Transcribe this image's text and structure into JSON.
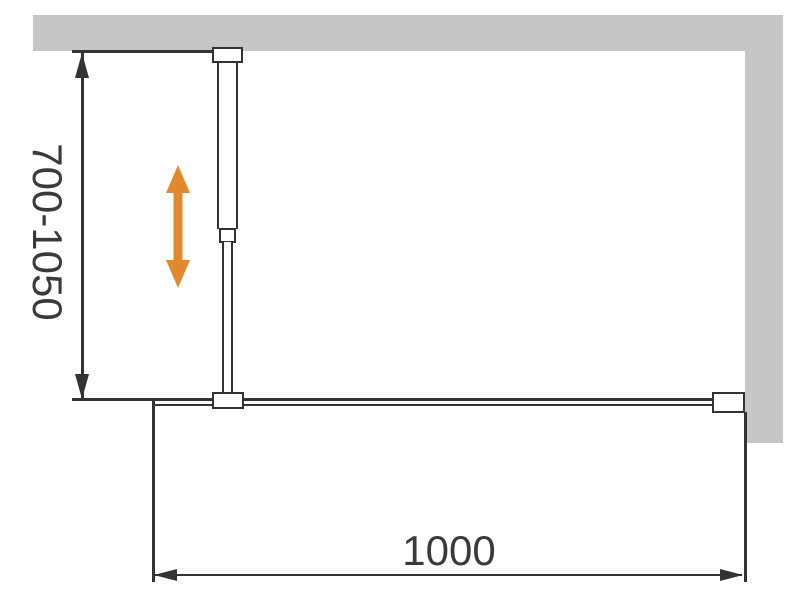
{
  "diagram": {
    "title": "shower-screen-installation-dimension-diagram",
    "dimensions": {
      "vertical": {
        "label": "700-1050"
      },
      "horizontal": {
        "label": "1000"
      }
    },
    "icons": {
      "adjust_arrow": "double-headed-vertical-arrow"
    },
    "colors": {
      "wall_gray": "#C6C6C6",
      "line_dark": "#333333",
      "accent_orange": "#E0892D",
      "background": "#FFFFFF"
    }
  }
}
